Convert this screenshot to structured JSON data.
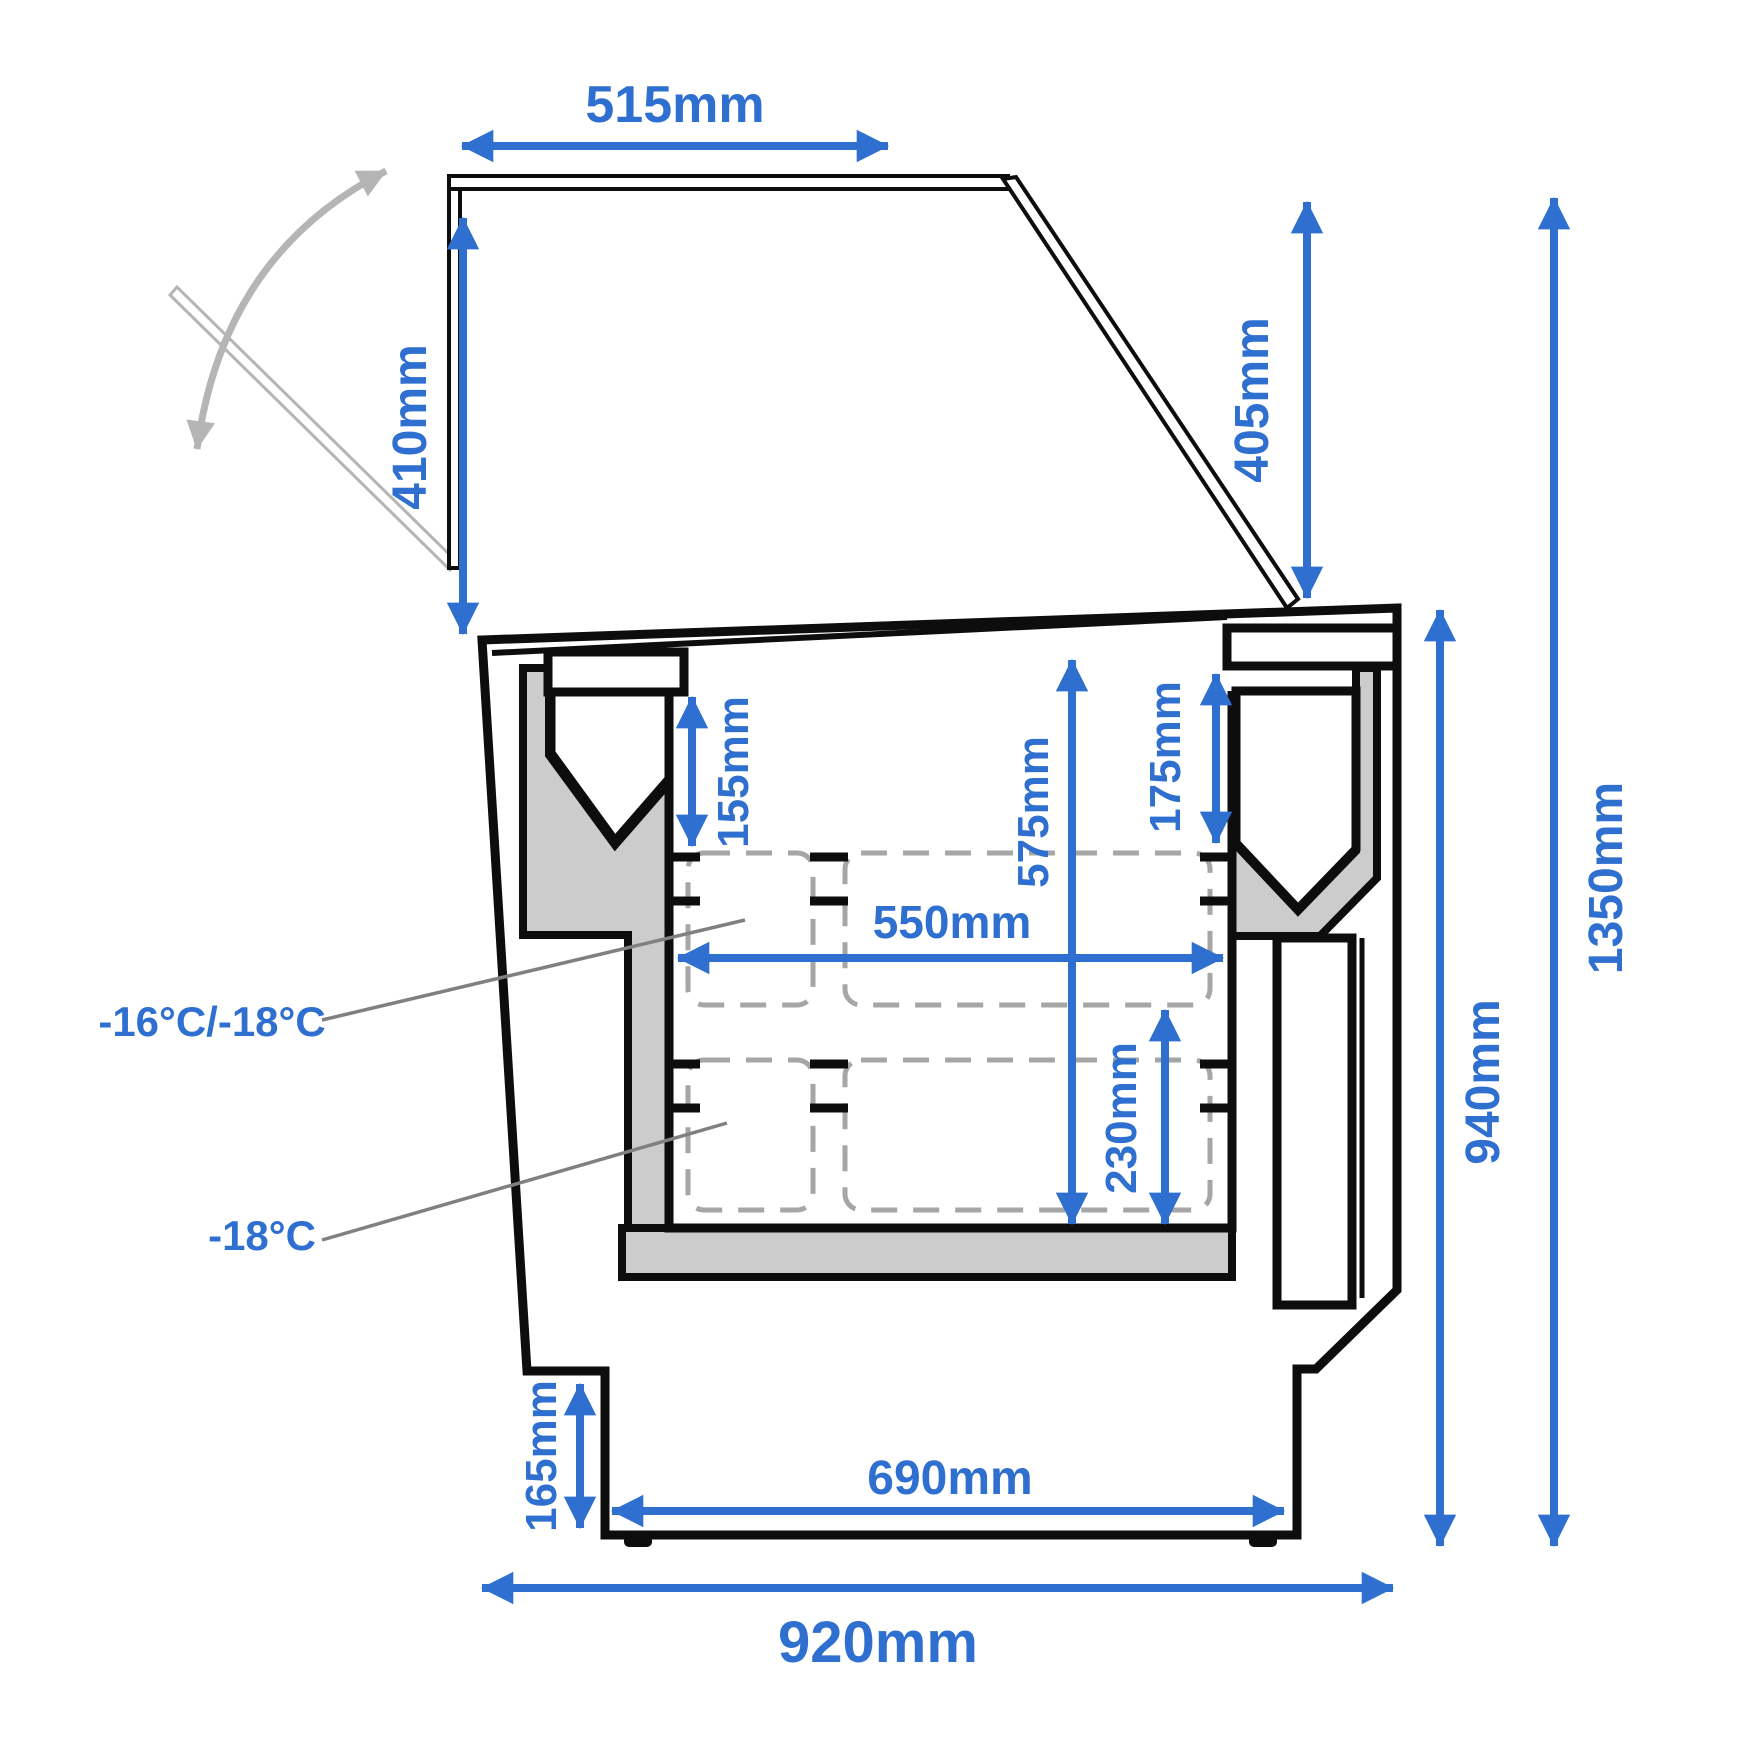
{
  "diagram": {
    "type": "technical-dimension-drawing",
    "subject": "chest freezer / ice-cream scooping counter cross-section with open glass lid",
    "units": "mm"
  },
  "dims": {
    "d515": "515mm",
    "d410": "410mm",
    "d405": "405mm",
    "d1350": "1350mm",
    "d940": "940mm",
    "d155": "155mm",
    "d175": "175mm",
    "d575": "575mm",
    "d550": "550mm",
    "d230": "230mm",
    "d165": "165mm",
    "d690": "690mm",
    "d920": "920mm"
  },
  "temps": {
    "upper": "-16°C/-18°C",
    "lower": "-18°C"
  },
  "colors": {
    "dimension_blue": "#2e6fd0",
    "outline_black": "#0d0d0d",
    "insulation_gray": "#cccccc",
    "basket_dash_gray": "#a6a6a6",
    "leader_gray": "#808080",
    "lid_motion_gray": "#b5b5b5",
    "background": "#ffffff"
  }
}
